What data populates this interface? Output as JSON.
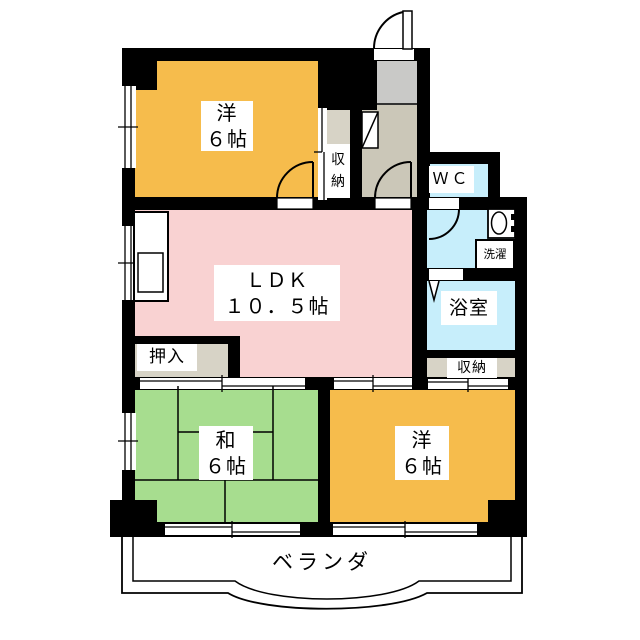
{
  "plan_labels": {
    "west_room": "洋\n６帖",
    "ldk": "ＬＤＫ\n１０．５帖",
    "japanese_room": "和\n６帖",
    "south_room": "洋\n６帖",
    "wc": "ＷＣ",
    "bath": "浴室",
    "laundry": "洗濯",
    "storage_east": "収納",
    "storage_north": "収\n納",
    "oshiire": "押入",
    "balcony": "ベランダ"
  },
  "room_summary": {
    "west_room_size": "6帖",
    "ldk_size": "10.5帖",
    "japanese_room_size": "6帖",
    "south_room_size": "6帖"
  },
  "colors": {
    "western_room": "#F6BC4C",
    "ldk": "#F9D2D2",
    "tatami_room": "#A7DD8F",
    "wet_area": "#C7EEFB",
    "storage": "#D7D3C6",
    "genkan": "#CBC7B8",
    "porch": "#C9C9C7",
    "wall": "#000000"
  }
}
